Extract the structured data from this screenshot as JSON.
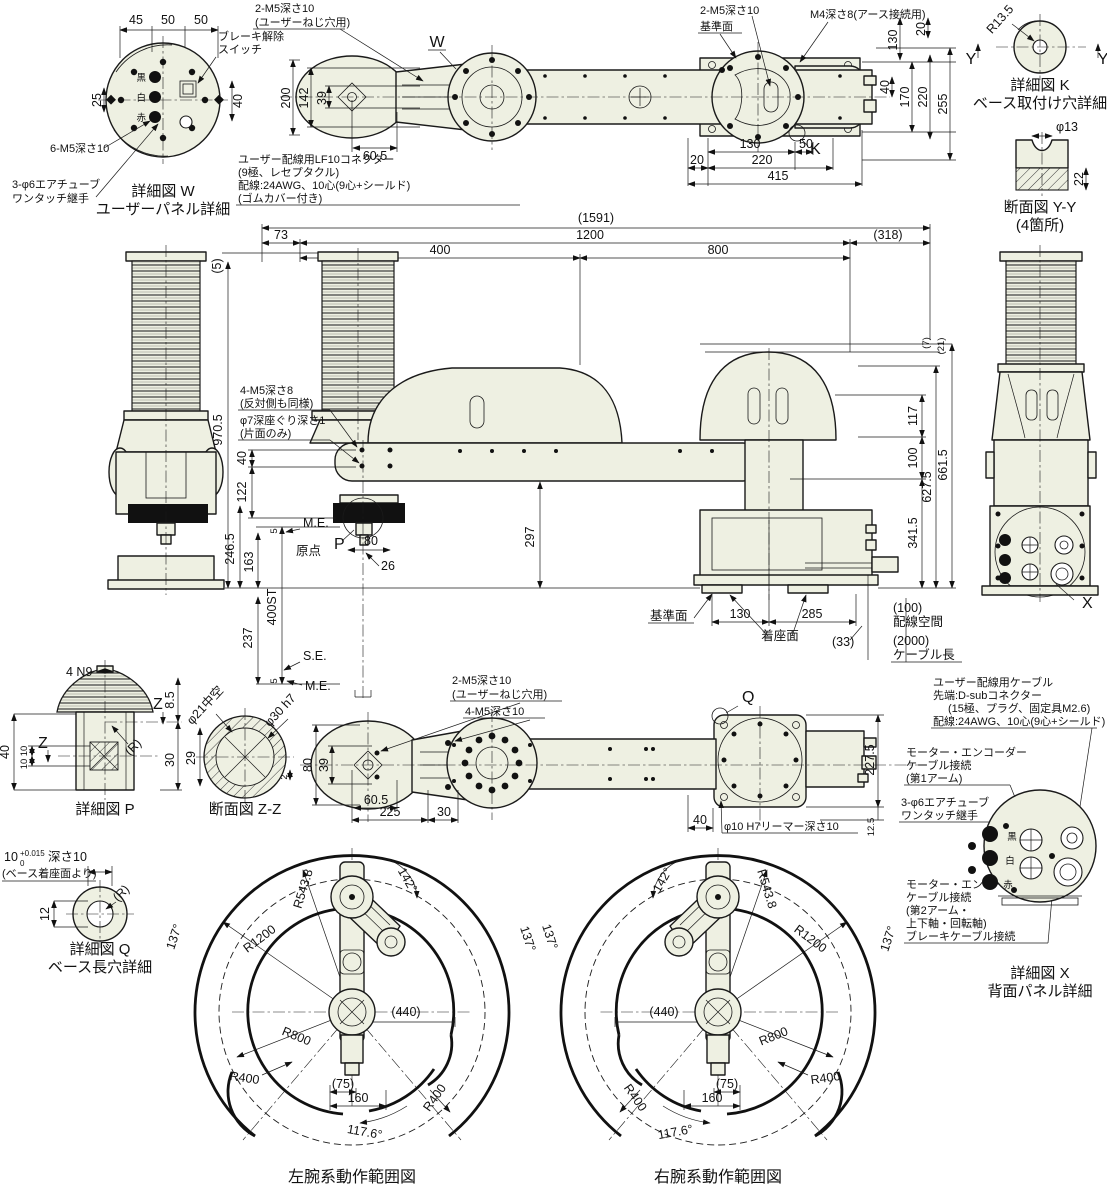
{
  "colors": {
    "line": "#1a1a1a",
    "body_fill": "#eef0e2",
    "background": "#ffffff"
  },
  "detail_w": {
    "title": "詳細図 W",
    "subtitle": "ユーザーパネル詳細",
    "dim_45": "45",
    "dim_50a": "50",
    "dim_50b": "50",
    "dim_25": "25",
    "dim_40": "40",
    "brake1": "ブレーキ解除",
    "brake2": "スイッチ",
    "m5": "6-M5深さ10",
    "air1": "3-φ6エアチューブ",
    "air2": "ワンタッチ継手",
    "wire_black": "黒",
    "wire_white": "白",
    "wire_red": "赤"
  },
  "plan": {
    "user_hole1": "2-M5深さ10",
    "user_hole2": "(ユーザーねじ穴用)",
    "marker_w": "W",
    "marker_k": "K",
    "dim_200": "200",
    "dim_142": "142",
    "dim_39": "39",
    "dim_60_5": "60.5",
    "conn1": "ユーザー配線用LF10コネクター",
    "conn2": "(9極、レセプタクル)",
    "conn3": "配線:24AWG、10心(9心+シールド)",
    "conn4": "(ゴムカバー付き)",
    "m5_right": "2-M5深さ10",
    "datum": "基準面",
    "earth": "M4深さ8(アース接続用)",
    "dim_130v": "130",
    "dim_20v": "20",
    "dim_40": "40",
    "dim_170": "170",
    "dim_220v": "220",
    "dim_255": "255",
    "dim_20": "20",
    "dim_130": "130",
    "dim_50": "50",
    "dim_220": "220",
    "dim_415": "415"
  },
  "detail_k": {
    "title": "詳細図 K",
    "subtitle": "ベース取付け穴詳細",
    "radius": "R13.5",
    "y1": "Y",
    "y2": "Y"
  },
  "section_yy": {
    "title": "断面図 Y-Y",
    "note": "(4箇所)",
    "dia": "φ13",
    "dim_22": "22"
  },
  "elev": {
    "d1591": "(1591)",
    "d73": "73",
    "d1200": "1200",
    "d318": "(318)",
    "d400": "400",
    "d800": "800",
    "d5t": "(5)",
    "d7": "(7)",
    "d21": "(21)",
    "d970": "970.5",
    "m5a": "4-M5深さ8",
    "m5b": "(反対側も同様)",
    "cba": "φ7深座ぐり深さ1",
    "cbb": "(片面のみ)",
    "d40": "40",
    "d122": "122",
    "d117": "117",
    "d100": "100",
    "d627": "627.5",
    "d661": "661.5",
    "d341": "341.5",
    "d297": "297",
    "d5me": "5",
    "me1": "M.E.",
    "d246": "246.5",
    "d163": "163",
    "origin": "原点",
    "mp": "P",
    "d80": "80",
    "d26": "26",
    "d400st": "400ST",
    "d237": "237",
    "se": "S.E.",
    "me2": "M.E.",
    "d5b": "5",
    "datum": "基準面",
    "d130": "130",
    "d285": "285",
    "seat": "着座面",
    "d33": "(33)",
    "d100w": "(100)",
    "wiring": "配線空間",
    "d2000": "(2000)",
    "cable": "ケーブル長",
    "mx": "X"
  },
  "detail_p": {
    "title": "詳細図 P",
    "n9": "4 N9",
    "z1": "Z",
    "z2": "Z",
    "d85": "8.5",
    "d40": "40",
    "d10a": "10",
    "d10b": "10",
    "d30": "30",
    "r": "(R)"
  },
  "section_zz": {
    "title": "断面図 Z-Z",
    "hollow": "φ21中空",
    "fit": "φ30 h7",
    "d29": "29",
    "d2": "2"
  },
  "detail_q": {
    "title": "詳細図 Q",
    "subtitle": "ベース長穴詳細",
    "tol_base": "10",
    "tol_sup": "+0.015",
    "tol_sub": "0",
    "depth": "深さ10",
    "from": "(ベース着座面より)",
    "d12": "12",
    "r": "(R)"
  },
  "bottom": {
    "uh1": "2-M5深さ10",
    "uh2": "(ユーザーねじ穴用)",
    "m5": "4-M5深さ10",
    "d80": "80",
    "d39": "39",
    "d60_5": "60.5",
    "d225": "225",
    "d30": "30",
    "mq": "Q",
    "d227": "227.5",
    "d40": "40",
    "reamer": "φ10 H7リーマー深さ10",
    "d12_5": "12.5"
  },
  "cables": {
    "u1": "ユーザー配線用ケーブル",
    "u2": "先端:D-subコネクター",
    "u3": "(15極、プラグ、固定具M2.6)",
    "u4": "配線:24AWG、10心(9心+シールド)",
    "m1a": "モーター・エンコーダー",
    "m1b": "ケーブル接続",
    "m1c": "(第1アーム)",
    "air1": "3-φ6エアチューブ",
    "air2": "ワンタッチ継手",
    "m2a": "モーター・エンコーダー",
    "m2b": "ケーブル接続",
    "m2c": "(第2アーム・",
    "m2d": "上下軸・回転軸)",
    "m2e": "ブレーキケーブル接続"
  },
  "detail_x": {
    "title": "詳細図 X",
    "subtitle": "背面パネル詳細",
    "wire_black": "黒",
    "wire_white": "白",
    "wire_red": "赤"
  },
  "env_left": {
    "title": "左腕系動作範囲図",
    "r543": "R543.8",
    "a142": "142°",
    "r1200": "R1200",
    "a137a": "137°",
    "a137b": "137°",
    "r800": "R800",
    "d440": "(440)",
    "r400a": "R400",
    "d75": "(75)",
    "d160": "160",
    "r400b": "R400",
    "a1176": "117.6°"
  },
  "env_right": {
    "title": "右腕系動作範囲図",
    "r543": "R543.8",
    "a142": "142°",
    "r1200": "R1200",
    "a137a": "137°",
    "a137b": "137°",
    "r800": "R800",
    "d440": "(440)",
    "r400a": "R400",
    "d75": "(75)",
    "d160": "160",
    "r400b": "R400",
    "a1176": "117.6°"
  }
}
